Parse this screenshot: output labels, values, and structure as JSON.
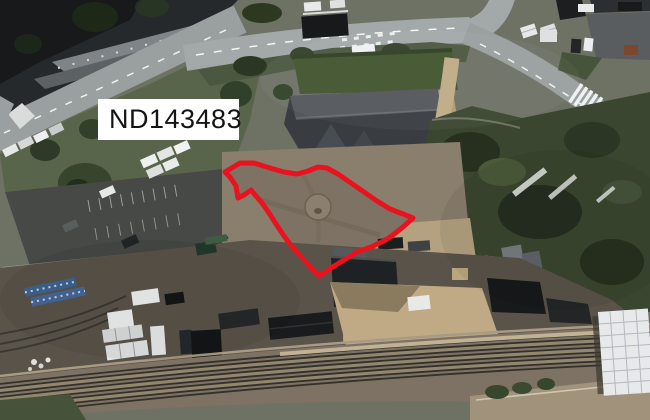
{
  "map": {
    "grid_reference_label": "ND143483",
    "boundary_overlay": {
      "points": "225,172 240,163 254,163 270,168 284,172 297,174 308,171 318,167 327,168 338,174 351,183 364,192 377,201 390,209 403,214 413,218 403,227 393,235 384,241 371,247 357,252 344,260 331,268 319,276 312,269 303,259 293,248 284,236 276,224 269,213 262,203 256,196 251,190 244,195 238,198 236,186 230,177",
      "color": "#e91320",
      "stroke_width": "5"
    },
    "label_box": {
      "background": "#ffffff",
      "text_color": "#141414"
    }
  }
}
